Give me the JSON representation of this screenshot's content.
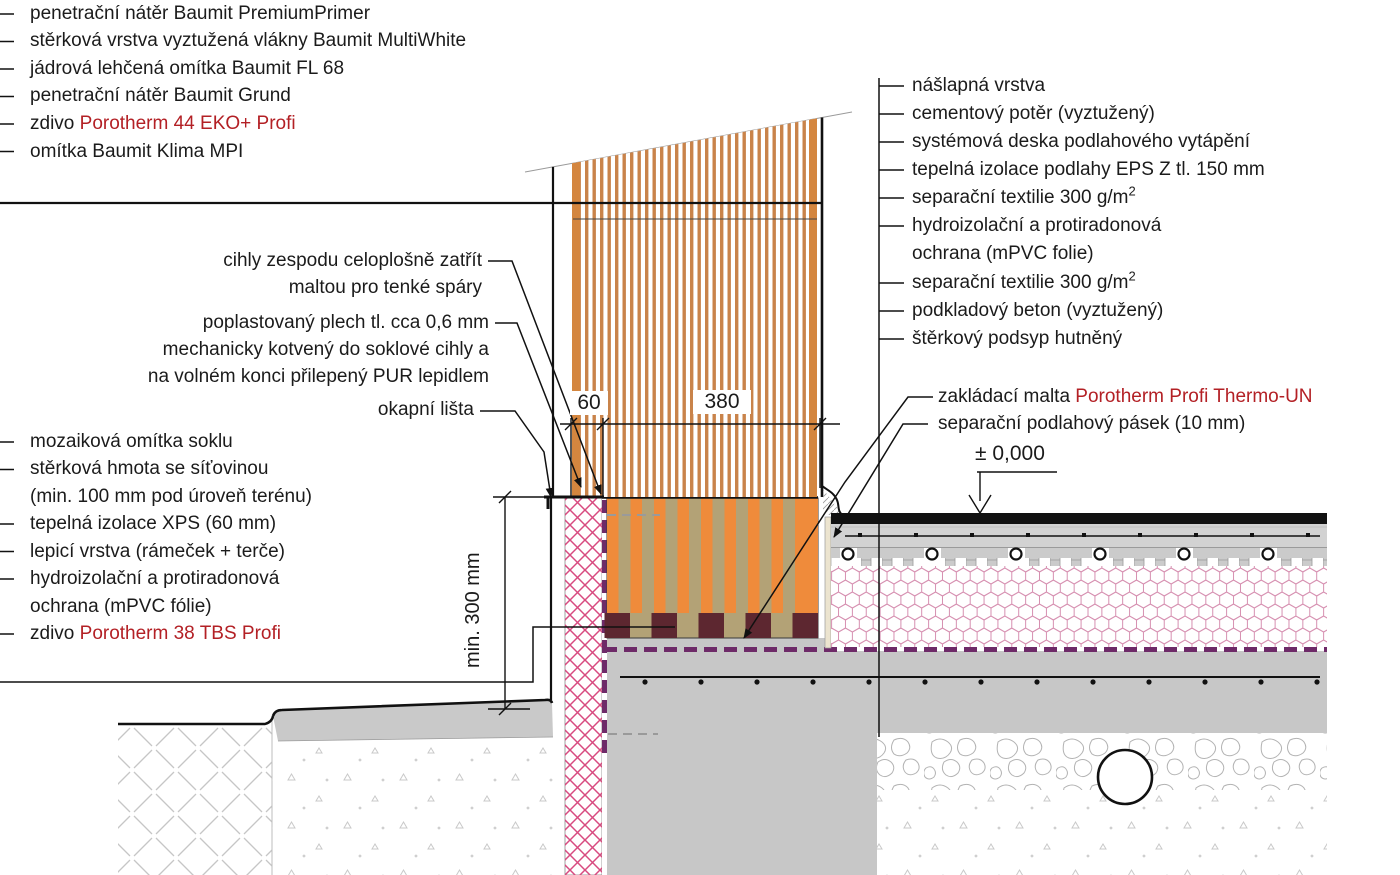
{
  "title": "Detail soklu — Porotherm (konstrukční detail)",
  "colors": {
    "accent_red_text": "#b32025",
    "wall_hatch_orange": "#c9834a",
    "plinth_stripe_orange": "#ef8b3b",
    "plinth_olive": "#b3a276",
    "mortar_maroon": "#5d2730",
    "xps_pink": "#d84b80",
    "eps_hex_pink": "#d68fb0",
    "membrane_purple": "#6e2a68",
    "concrete_gray": "#c7c7c7"
  },
  "labels": {
    "left_top": {
      "items": [
        {
          "pre": "penetrační nátěr Baumit PremiumPrimer"
        },
        {
          "pre": "stěrková vrstva vyztužená vlákny Baumit MultiWhite"
        },
        {
          "pre": "jádrová lehčená omítka Baumit FL 68"
        },
        {
          "pre": "penetrační nátěr Baumit Grund"
        },
        {
          "pre": "zdivo ",
          "brand": "Porotherm 44 EKO+ Profi"
        },
        {
          "pre": "omítka Baumit Klima MPI"
        }
      ]
    },
    "left_mid": {
      "lines": [
        "cihly zespodu celoplošně zatřít",
        "maltou pro tenké spáry",
        "poplastovaný plech tl. cca 0,6 mm",
        "mechanicky kotvený do soklové cihly a",
        "na volném konci přilepený PUR lepidlem",
        "okapní lišta"
      ]
    },
    "left_bottom": {
      "items": [
        {
          "pre": "mozaiková omítka soklu"
        },
        {
          "pre": "stěrková hmota se síťovinou"
        },
        {
          "pre": "(min. 100 mm pod úroveň terénu)"
        },
        {
          "pre": "tepelná izolace XPS (60 mm)"
        },
        {
          "pre": "lepicí vrstva (rámeček + terče)"
        },
        {
          "pre": "hydroizolační a protiradonová"
        },
        {
          "pre": "ochrana (mPVC fólie)"
        },
        {
          "pre": "zdivo ",
          "brand": "Porotherm 38 TBS Profi"
        }
      ]
    },
    "right_top": {
      "items": [
        {
          "pre": "nášlapná vrstva"
        },
        {
          "pre": "cementový potěr (vyztužený)"
        },
        {
          "pre": "systémová deska podlahového vytápění"
        },
        {
          "pre": "tepelná izolace podlahy EPS Z tl. 150 mm"
        },
        {
          "pre": "separační textilie 300 g/m",
          "sup": "2"
        },
        {
          "pre": "hydroizolační a protiradonová"
        },
        {
          "pre": "ochrana (mPVC folie)"
        },
        {
          "pre": "separační textilie 300 g/m",
          "sup": "2"
        },
        {
          "pre": "podkladový beton (vyztužený)"
        },
        {
          "pre": "štěrkový podsyp hutněný"
        }
      ]
    },
    "right_mid": {
      "items": [
        {
          "pre": "zakládací malta ",
          "brand": "Porotherm Profi Thermo-UN"
        },
        {
          "pre": "separační podlahový pásek (10 mm)"
        }
      ]
    }
  },
  "dimensions": {
    "width_xps": "60",
    "width_wall": "380",
    "depth": "min. 300 mm",
    "level": "± 0,000"
  }
}
